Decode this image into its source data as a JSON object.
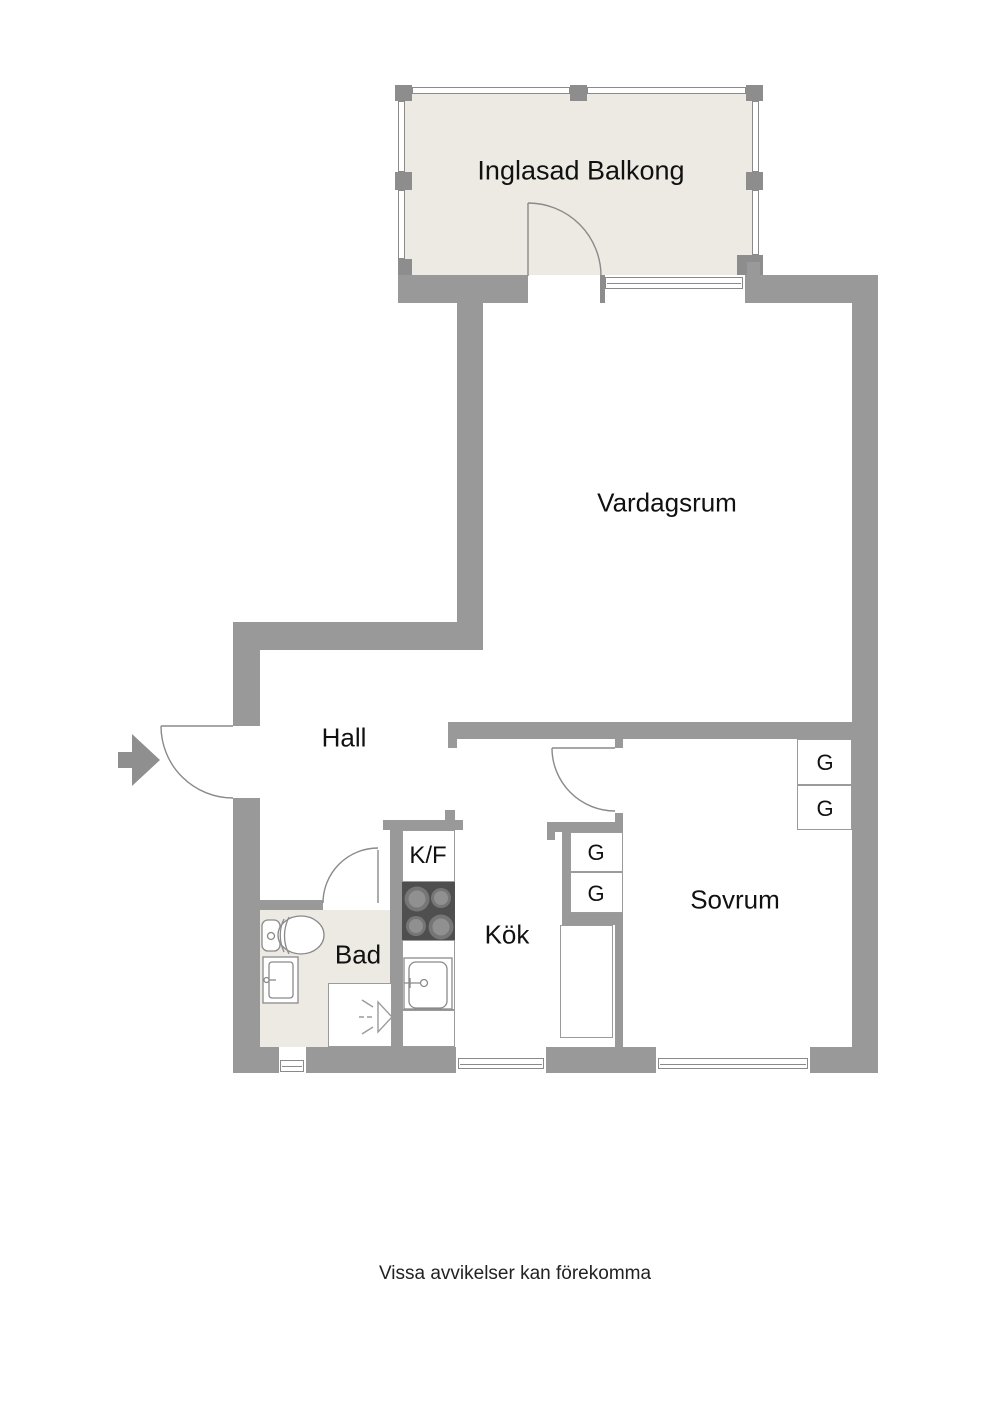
{
  "plan": {
    "rooms": {
      "balcony": "Inglasad Balkong",
      "living_room": "Vardagsrum",
      "hall": "Hall",
      "kitchen": "Kök",
      "bathroom": "Bad",
      "bedroom": "Sovrum"
    },
    "fixtures": {
      "fridge_freezer": "K/F"
    },
    "wardrobes": {
      "kitchen": [
        "G",
        "G"
      ],
      "bedroom": [
        "G",
        "G"
      ]
    },
    "footer": {
      "disclaimer": "Vissa avvikelser kan förekomma"
    },
    "colors": {
      "wall": "#999999",
      "wall_dark": "#8d8d8d",
      "floor_beige": "#edeae4",
      "stove_dark": "#4f4f4f",
      "thin_line": "#8a8a8a",
      "text": "#111111"
    }
  }
}
